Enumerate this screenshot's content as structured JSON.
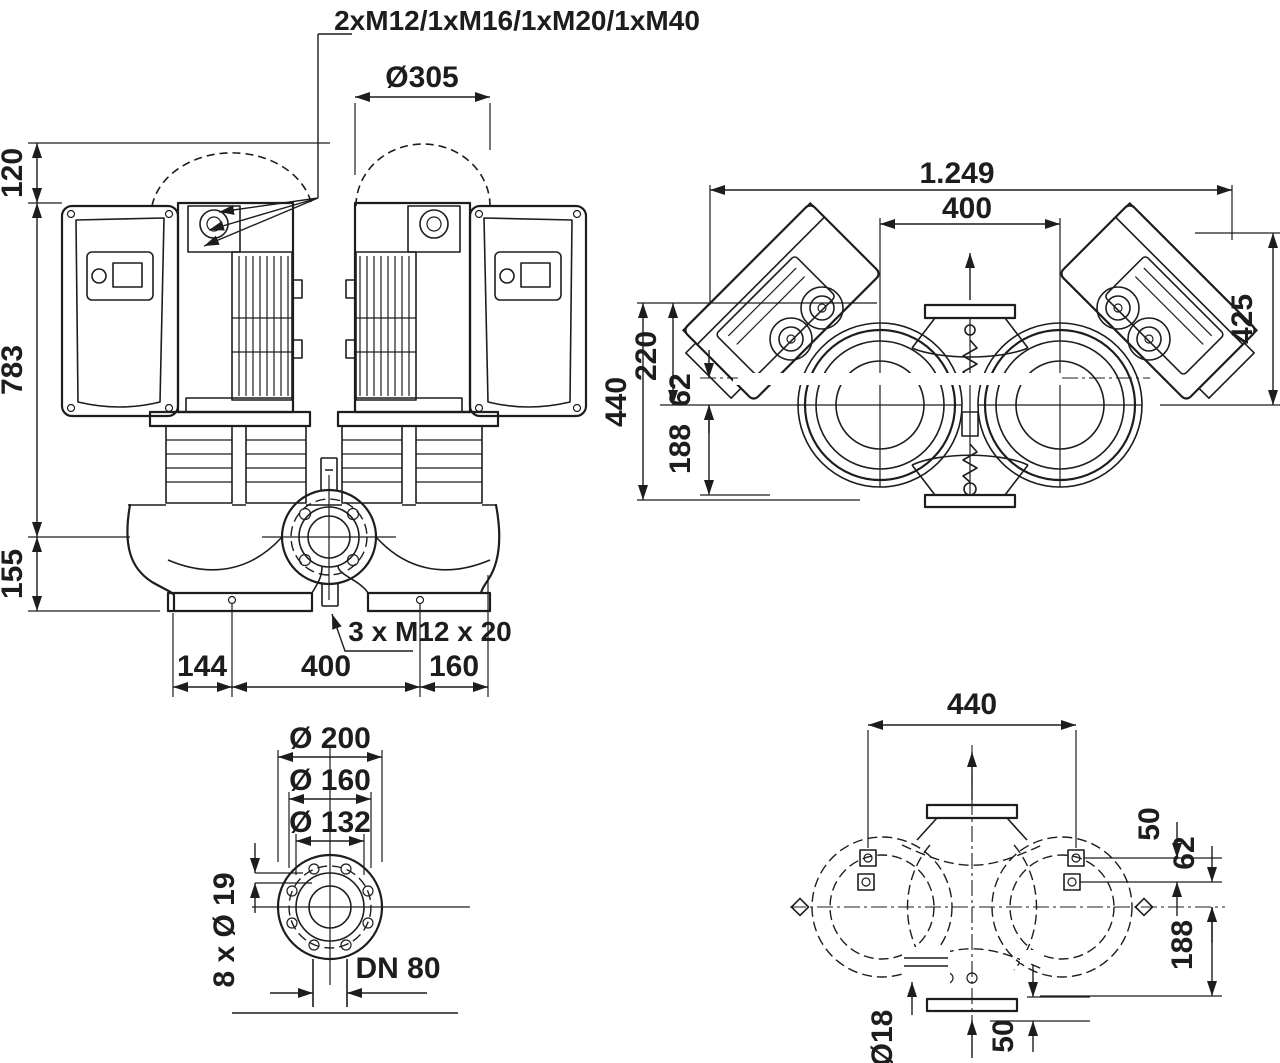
{
  "front": {
    "gland_label": "2xM12/1xM16/1xM20/1xM40",
    "module_circle_dia": "Ø305",
    "clearance_top": "120",
    "height_above_axis": "783",
    "height_below_axis": "155",
    "foot_offset_left": "144",
    "bolt_spacing": "400",
    "foot_offset_right": "160",
    "plug_label": "3 x M12 x 20"
  },
  "top": {
    "overall_width": "1.249",
    "shaft_distance": "400",
    "module_extent": "425",
    "overall_depth": "440",
    "top_to_axis": "220",
    "port_to_axis": "62",
    "axis_to_edge": "188"
  },
  "flange": {
    "flange_od": "Ø 200",
    "bolt_circle": "Ø 160",
    "raised_face": "Ø 132",
    "bolt_holes": "8 x Ø 19",
    "nominal_dia": "DN 80"
  },
  "foundation": {
    "bolt_spacing": "440",
    "bolt_row_gap": "50",
    "port_to_axis": "62",
    "axis_to_edge": "188",
    "hole_dia": "Ø18",
    "edge_gap": "50"
  },
  "colors": {
    "ink": "#1d1d1b",
    "paper": "#ffffff"
  }
}
